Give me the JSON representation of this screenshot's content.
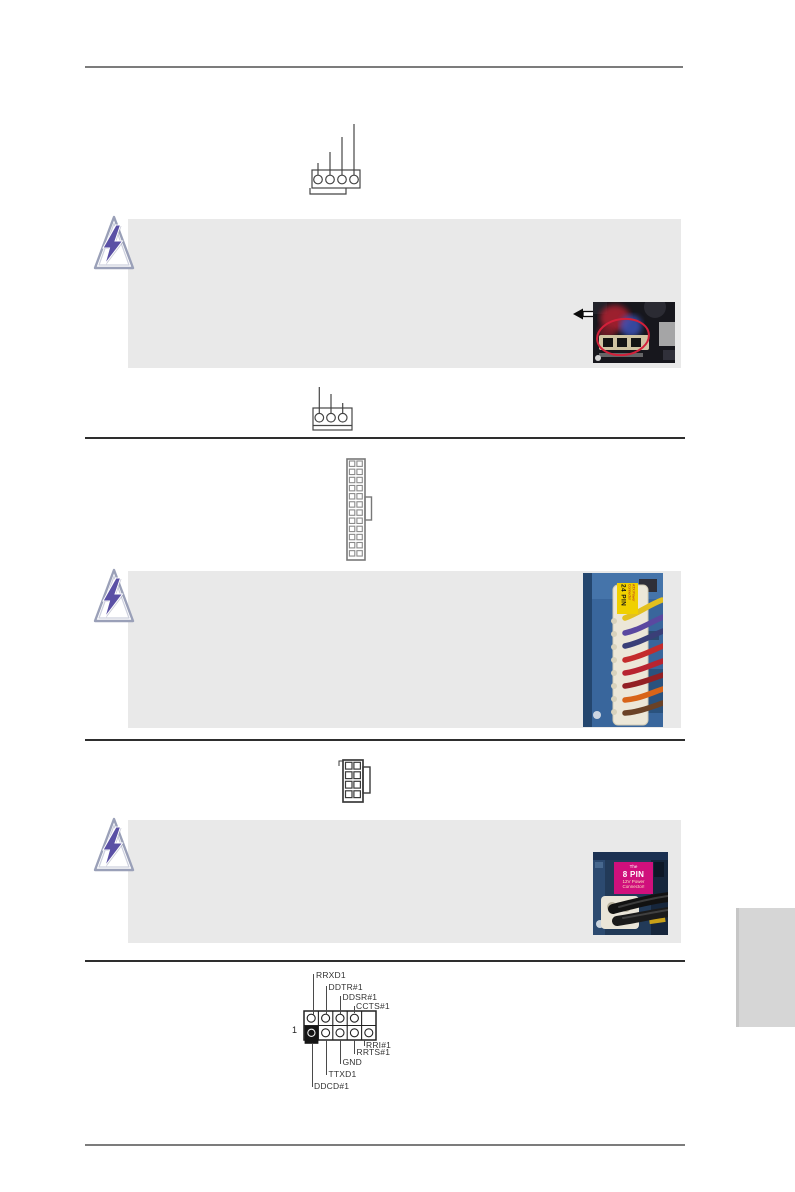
{
  "colors": {
    "note_box_bg": "#e9e9e9",
    "rule_dark": "#2e2e2e",
    "rule_light": "#7c7c7c",
    "bolt_purple": "#5a50a5",
    "side_tab_gray": "#d6d6d6",
    "annotation_red": "#d3203a",
    "pcb_blue": "#39669c",
    "label_yellow": "#f0d000",
    "label_magenta": "#d0107c"
  },
  "diagrams": {
    "fan_connector_top_pins": 4,
    "fan_connector_mid_pins": 3,
    "atx_power_rows": 12,
    "atx_power_cols": 2,
    "atx12v_rows": 4,
    "atx12v_cols": 2
  },
  "photos": {
    "atx_24pin": {
      "label_main": "24 PIN",
      "label_sub": "ATX Power Connector"
    },
    "atx_8pin": {
      "label_lines": [
        "The",
        "8 PIN",
        "12V Power",
        "Connector!"
      ]
    }
  },
  "serial_header": {
    "pin1_marker": "1",
    "top_labels": [
      "RRXD1",
      "DDTR#1",
      "DDSR#1",
      "CCTS#1"
    ],
    "bottom_labels": [
      "RRI#1",
      "RRTS#1",
      "GND",
      "TTXD1",
      "DDCD#1"
    ]
  }
}
